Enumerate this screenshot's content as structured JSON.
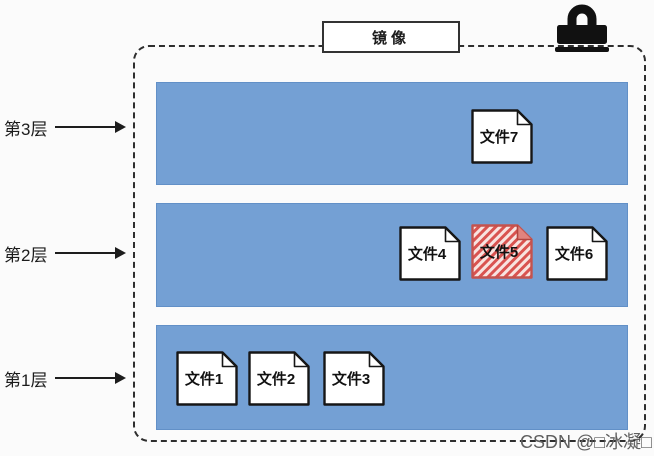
{
  "container": {
    "title": "镜像"
  },
  "icons": {
    "lock": "lock-icon",
    "arrow": "arrow-right-icon",
    "file": "document-icon"
  },
  "colors": {
    "layer_fill": "#74a0d4",
    "layer_border": "#6290c7",
    "file_fill": "#ffffff",
    "file_stroke": "#161616",
    "highlight_stripe": "#d95350",
    "highlight_bg": "#f8e3e0",
    "highlight_stroke": "#c4534e",
    "dashed_border": "#2e2e2e",
    "watermark_color": "#5f5f5f"
  },
  "layers": [
    {
      "label": "第3层",
      "top": 82,
      "height": 103,
      "label_top": 116,
      "files": [
        {
          "name": "文件7",
          "x": 314,
          "y": 26,
          "highlight": false
        }
      ]
    },
    {
      "label": "第2层",
      "top": 203,
      "height": 104,
      "label_top": 242,
      "files": [
        {
          "name": "文件4",
          "x": 242,
          "y": 22,
          "highlight": false
        },
        {
          "name": "文件5",
          "x": 314,
          "y": 20,
          "highlight": true
        },
        {
          "name": "文件6",
          "x": 389,
          "y": 22,
          "highlight": false
        }
      ]
    },
    {
      "label": "第1层",
      "top": 325,
      "height": 105,
      "label_top": 367,
      "files": [
        {
          "name": "文件1",
          "x": 19,
          "y": 25,
          "highlight": false
        },
        {
          "name": "文件2",
          "x": 91,
          "y": 25,
          "highlight": false
        },
        {
          "name": "文件3",
          "x": 166,
          "y": 25,
          "highlight": false
        }
      ]
    }
  ],
  "watermark": {
    "text": "CSDN @□冰凝□"
  }
}
